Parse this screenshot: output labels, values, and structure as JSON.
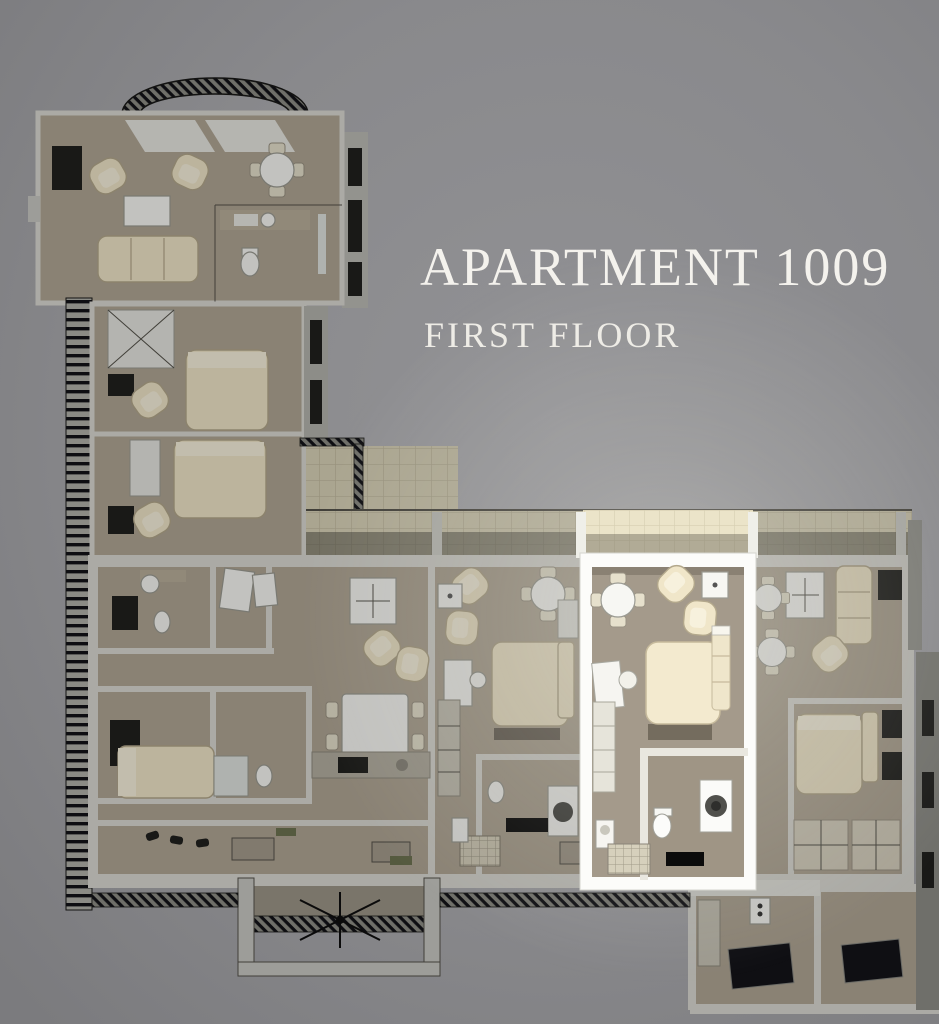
{
  "header": {
    "title": "APARTMENT 1009",
    "subtitle": "FIRST FLOOR"
  },
  "colors": {
    "background": "#88888b",
    "title_text": "#f4f2ed",
    "highlight_frame": "#fcfcfa",
    "highlight_floor": "#a49a8b",
    "dimmed_floor": "#665f56",
    "cream_furniture": "#f0e6c9",
    "terrace_tile_lit": "#ebe4c9",
    "terrace_tile_dim": "#7e7a6b"
  }
}
